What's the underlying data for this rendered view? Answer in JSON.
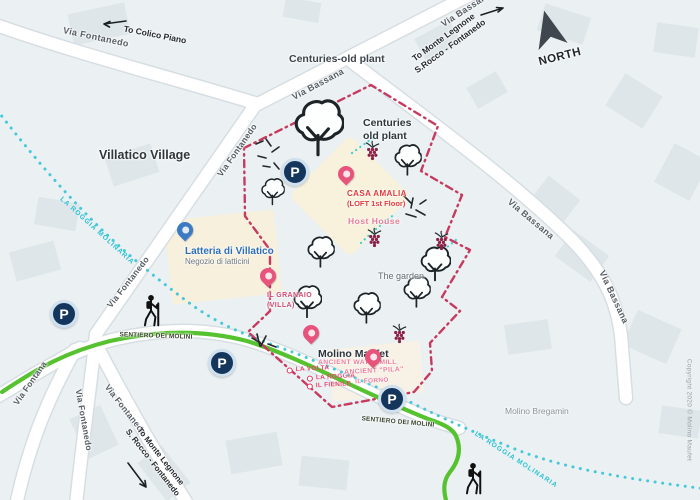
{
  "map": {
    "parking_label": "P",
    "region": "Villatico Village",
    "north": "NORTH",
    "copyright": "Copyright 2020 © Molino Maufet",
    "waterway": "LA ROGGIA MOLINARIA",
    "roads": {
      "via_fontanedo": "Via Fontanedo",
      "via_bassana": "Via Bassana",
      "via_fontana": "Via Fontana",
      "sentiero": "SENTIERO DEI MOLINI"
    },
    "directions": {
      "colico": "To Colico Piano",
      "monte_top_1": "To Monte Legnone",
      "monte_top_2": "S.Rocco - Fontanedo",
      "monte_bottom_1": "To Monte Legnone",
      "monte_bottom_2": "S. Rocco - Fontanedo"
    },
    "pois": {
      "centuries_top": "Centuries-old plant",
      "centuries_inner_1": "Centuries",
      "centuries_inner_2": "old plant",
      "latteria_title": "Latteria di Villatico",
      "latteria_sub": "Negozio di latticini",
      "casa_title": "CASA AMALIA",
      "casa_sub": "(LOFT 1st Floor)",
      "host_house": "Host House",
      "granaio_1": "IL GRANAIO",
      "granaio_2": "(VILLA)",
      "garden": "The garden",
      "molino_title": "Molino Maufet",
      "molino_sub": "ANCIENT WATERMILL",
      "la_volta": "LA VOLTA",
      "la_roggia": "LA ROGGIA",
      "il_fienile": "IL FIENILE",
      "pila": "ANCIENT \"PILA\"",
      "il_forno": "IL FORNO",
      "bregamin": "Molino Bregamin"
    },
    "colors": {
      "boundary": "#c73a5f",
      "trail_green": "#57c22f",
      "water": "#45c8d8",
      "parking_blue": "#14365d",
      "accent_red": "#e23b3b",
      "accent_pink": "#ef7f9b",
      "label_blue": "#2e6fb7"
    }
  }
}
